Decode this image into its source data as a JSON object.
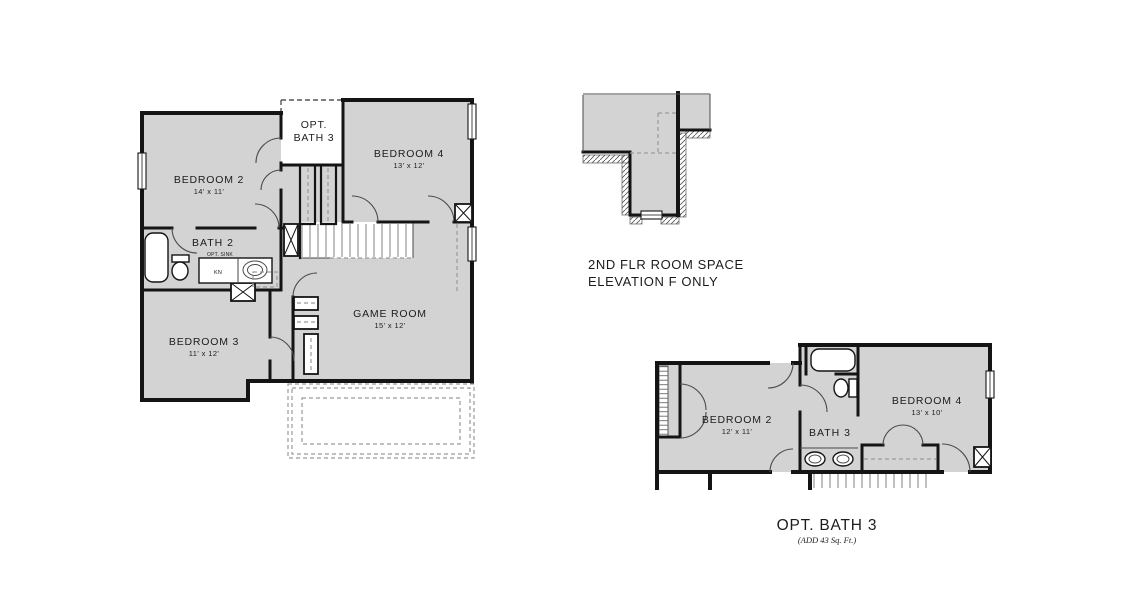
{
  "colors": {
    "room_fill": "#d3d3d3",
    "wall": "#141414",
    "thin_line": "#4a4a4a",
    "dash_line": "#9a9a9a",
    "tread": "#8c8c8c",
    "text": "#1c1c1c",
    "background": "#ffffff"
  },
  "main_plan": {
    "bedroom2": {
      "name": "BEDROOM 2",
      "dims": "14' x 11'"
    },
    "bedroom3": {
      "name": "BEDROOM 3",
      "dims": "11' x 12'"
    },
    "bedroom4": {
      "name": "BEDROOM 4",
      "dims": "13' x 12'"
    },
    "game_room": {
      "name": "GAME ROOM",
      "dims": "15' x 12'"
    },
    "bath2": {
      "name": "BATH 2",
      "opt_sink_label": "OPT. SINK",
      "cabinet_label": "KN"
    },
    "opt_bath3": {
      "line1": "OPT.",
      "line2": "BATH 3"
    }
  },
  "elevation_detail": {
    "caption_line1": "2ND FLR ROOM SPACE",
    "caption_line2": "ELEVATION F ONLY"
  },
  "opt_bath_plan": {
    "bedroom2": {
      "name": "BEDROOM 2",
      "dims": "12' x 11'"
    },
    "bedroom4": {
      "name": "BEDROOM 4",
      "dims": "13' x 10'"
    },
    "bath3": {
      "name": "BATH 3"
    },
    "caption": "OPT. BATH 3",
    "caption_note": "(ADD 43  Sq. Ft.)"
  }
}
